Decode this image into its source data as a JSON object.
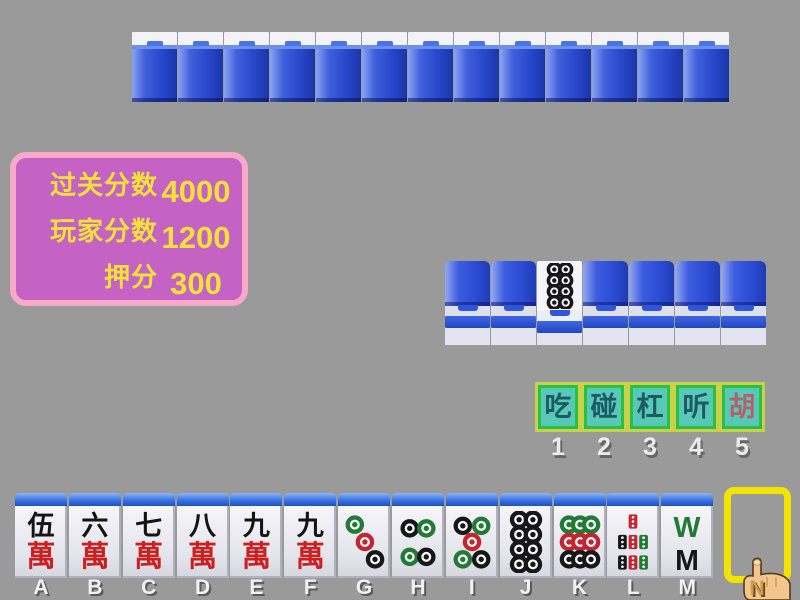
{
  "colors": {
    "background": "#9a9a9a",
    "panel_border": "#f7a9c9",
    "panel_fill": "#c463c4",
    "panel_text": "#f2e13a",
    "button_outer_border": "#c9d04a",
    "button_inner_border": "#29c043",
    "button_fill": "#58c8b8",
    "button_text": "#1d5a64",
    "button_text_hu": "#b5606a",
    "tile_back_blue": "#2a4ecd",
    "slot_border": "#f2e400",
    "dot_green": "#237a36",
    "dot_red": "#c32531",
    "dot_black": "#17171a",
    "wan_char_color": "#141414",
    "wan_label_color": "#cc2020"
  },
  "score_panel": {
    "rows": [
      {
        "label": "过关分数",
        "value": "4000"
      },
      {
        "label": "玩家分数",
        "value": "1200"
      },
      {
        "label": "押分",
        "value": "300"
      }
    ]
  },
  "action_bar": {
    "buttons": [
      {
        "label": "吃",
        "number": "1"
      },
      {
        "label": "碰",
        "number": "2"
      },
      {
        "label": "杠",
        "number": "3"
      },
      {
        "label": "听",
        "number": "4"
      },
      {
        "label": "胡",
        "number": "5"
      }
    ]
  },
  "opponent_row": {
    "tile_count": 13
  },
  "meld_row": {
    "tiles": [
      "back",
      "back",
      "dots8",
      "back",
      "back",
      "back",
      "back"
    ]
  },
  "tile_faces": {
    "wan5": {
      "type": "wan",
      "top": "伍",
      "bottom": "萬"
    },
    "wan6": {
      "type": "wan",
      "top": "六",
      "bottom": "萬"
    },
    "wan7": {
      "type": "wan",
      "top": "七",
      "bottom": "萬"
    },
    "wan8": {
      "type": "wan",
      "top": "八",
      "bottom": "萬"
    },
    "wan9": {
      "type": "wan",
      "top": "九",
      "bottom": "萬"
    },
    "dots3": {
      "type": "dots",
      "dots": [
        [
          30,
          22,
          "g"
        ],
        [
          52,
          50,
          "r"
        ],
        [
          74,
          78,
          "b"
        ]
      ]
    },
    "dots4": {
      "type": "dots",
      "dots": [
        [
          32,
          28,
          "b"
        ],
        [
          68,
          28,
          "g"
        ],
        [
          32,
          74,
          "g"
        ],
        [
          68,
          74,
          "b"
        ]
      ]
    },
    "dots5": {
      "type": "dots",
      "dots": [
        [
          30,
          24,
          "b"
        ],
        [
          70,
          24,
          "g"
        ],
        [
          50,
          50,
          "r"
        ],
        [
          30,
          78,
          "g"
        ],
        [
          70,
          78,
          "b"
        ]
      ]
    },
    "dots8": {
      "type": "dots",
      "dots": [
        [
          35,
          14,
          "b"
        ],
        [
          65,
          14,
          "b"
        ],
        [
          35,
          38,
          "b"
        ],
        [
          65,
          38,
          "b"
        ],
        [
          35,
          62,
          "b"
        ],
        [
          65,
          62,
          "b"
        ],
        [
          35,
          86,
          "b"
        ],
        [
          65,
          86,
          "b"
        ]
      ]
    },
    "dots9": {
      "type": "dots",
      "dots": [
        [
          26,
          22,
          "g"
        ],
        [
          50,
          22,
          "g"
        ],
        [
          74,
          22,
          "g"
        ],
        [
          26,
          50,
          "r"
        ],
        [
          50,
          50,
          "r"
        ],
        [
          74,
          50,
          "r"
        ],
        [
          26,
          78,
          "b"
        ],
        [
          50,
          78,
          "b"
        ],
        [
          74,
          78,
          "b"
        ]
      ]
    },
    "bamboo7": {
      "type": "bamboo",
      "sticks": [
        [
          50,
          17,
          "r"
        ],
        [
          27,
          50,
          "b"
        ],
        [
          50,
          50,
          "r"
        ],
        [
          73,
          50,
          "g"
        ],
        [
          27,
          83,
          "b"
        ],
        [
          50,
          83,
          "r"
        ],
        [
          73,
          83,
          "g"
        ]
      ]
    },
    "bamboo8": {
      "type": "bamboo_wm",
      "glyphs": [
        "W",
        "M"
      ]
    }
  },
  "hand": {
    "slots": [
      "A",
      "B",
      "C",
      "D",
      "E",
      "F",
      "G",
      "H",
      "I",
      "J",
      "K",
      "L",
      "M"
    ],
    "tiles": [
      "wan5",
      "wan6",
      "wan7",
      "wan8",
      "wan9",
      "wan9",
      "dots3",
      "dots4",
      "dots5",
      "dots8",
      "dots9",
      "bamboo7",
      "bamboo8"
    ],
    "next_slot_label": "N"
  }
}
